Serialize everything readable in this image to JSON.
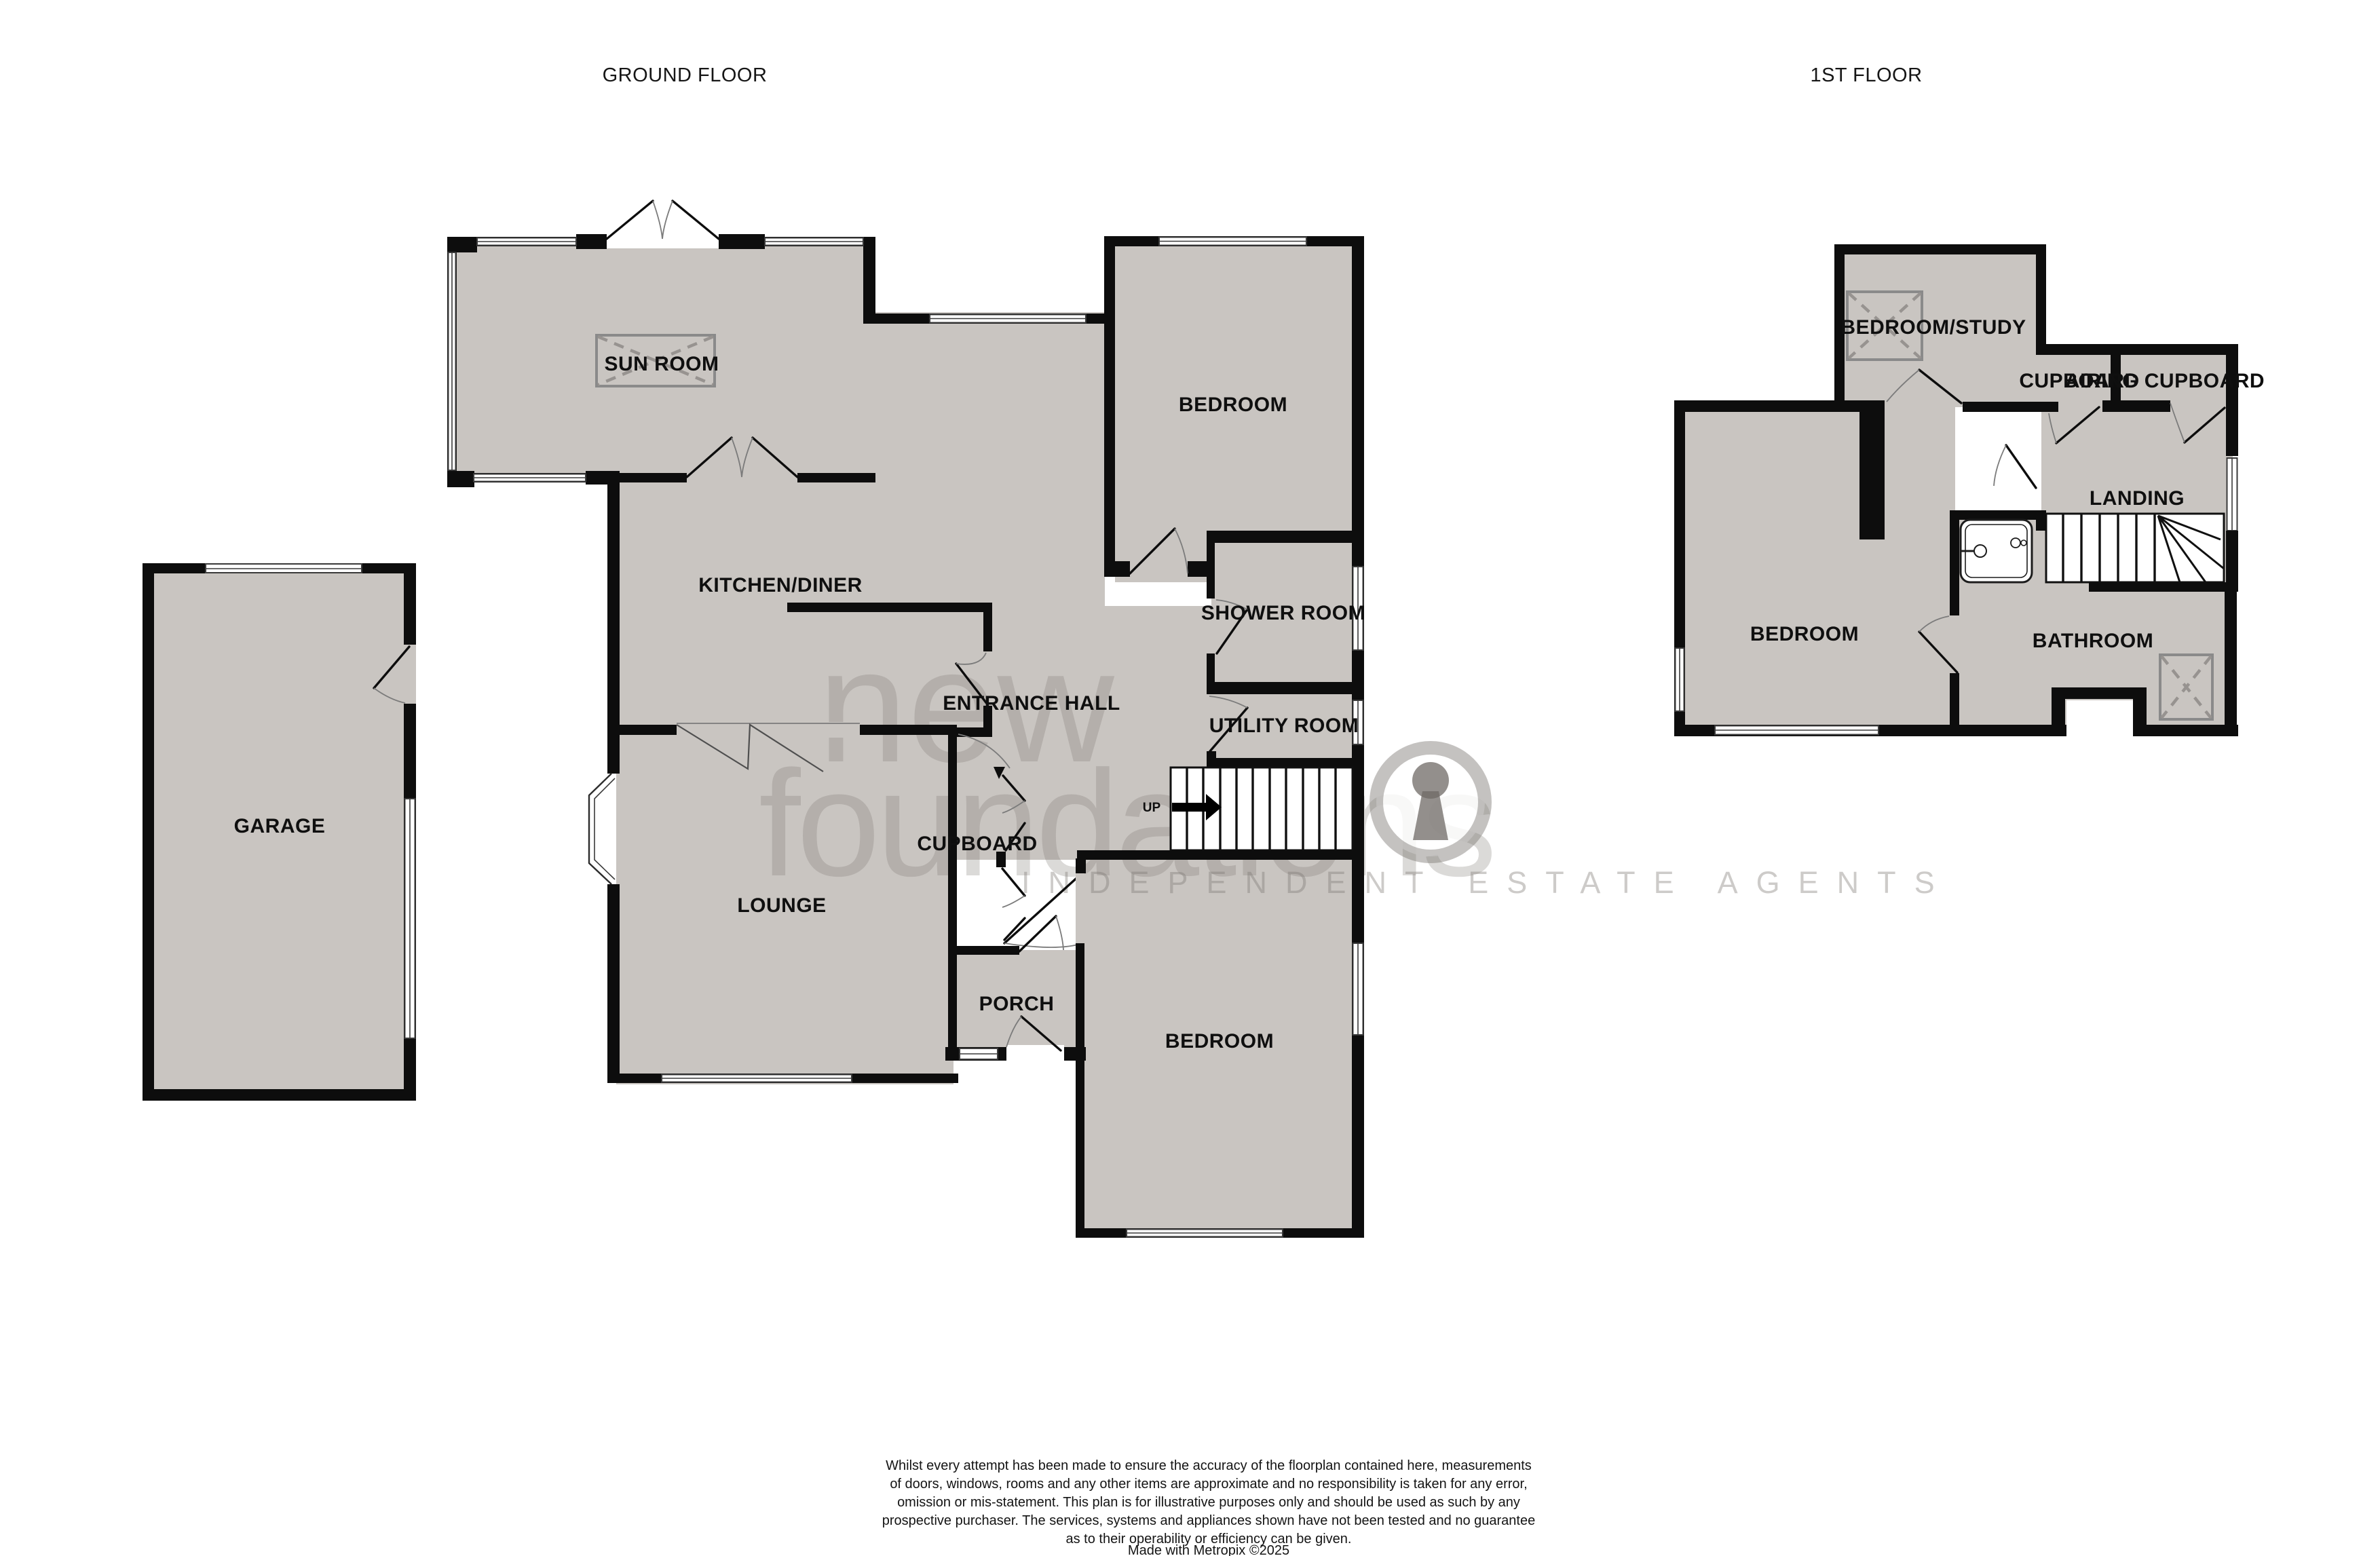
{
  "titles": {
    "ground": "GROUND FLOOR",
    "first": "1ST FLOOR"
  },
  "ground_rooms": {
    "sun_room": "SUN ROOM",
    "kitchen_diner": "KITCHEN/DINER",
    "bedroom_top": "BEDROOM",
    "shower_room": "SHOWER ROOM",
    "entrance_hall": "ENTRANCE HALL",
    "utility_room": "UTILITY ROOM",
    "cupboard": "CUPBOARD",
    "lounge": "LOUNGE",
    "porch": "PORCH",
    "bedroom_bottom": "BEDROOM",
    "garage": "GARAGE",
    "stairs_up": "UP"
  },
  "first_rooms": {
    "bedroom_study": "BEDROOM/STUDY",
    "cupboard": "CUPBOARD",
    "airing_cupboard": "AIRING CUPBOARD",
    "landing": "LANDING",
    "bedroom": "BEDROOM",
    "bathroom": "BATHROOM"
  },
  "watermark": {
    "line1": "new",
    "line2": "foundations",
    "tagline": "INDEPENDENT ESTATE AGENTS"
  },
  "disclaimer": {
    "line1": "Whilst every attempt has been made to ensure the accuracy of the floorplan contained here, measurements",
    "line2": "of doors, windows, rooms and any other items are approximate and no responsibility is taken for any error,",
    "line3": "omission or mis-statement. This plan is for illustrative purposes only and should be used as such by any",
    "line4": "prospective purchaser. The services, systems and appliances shown have not been tested and no guarantee",
    "line5": "as to their operability or efficiency can be given.",
    "line6": "Made with Metropix ©2025"
  },
  "colors": {
    "floor": "#c9c5c1",
    "wall": "#0d0d0d",
    "watermark_gray": "#7d7873"
  }
}
